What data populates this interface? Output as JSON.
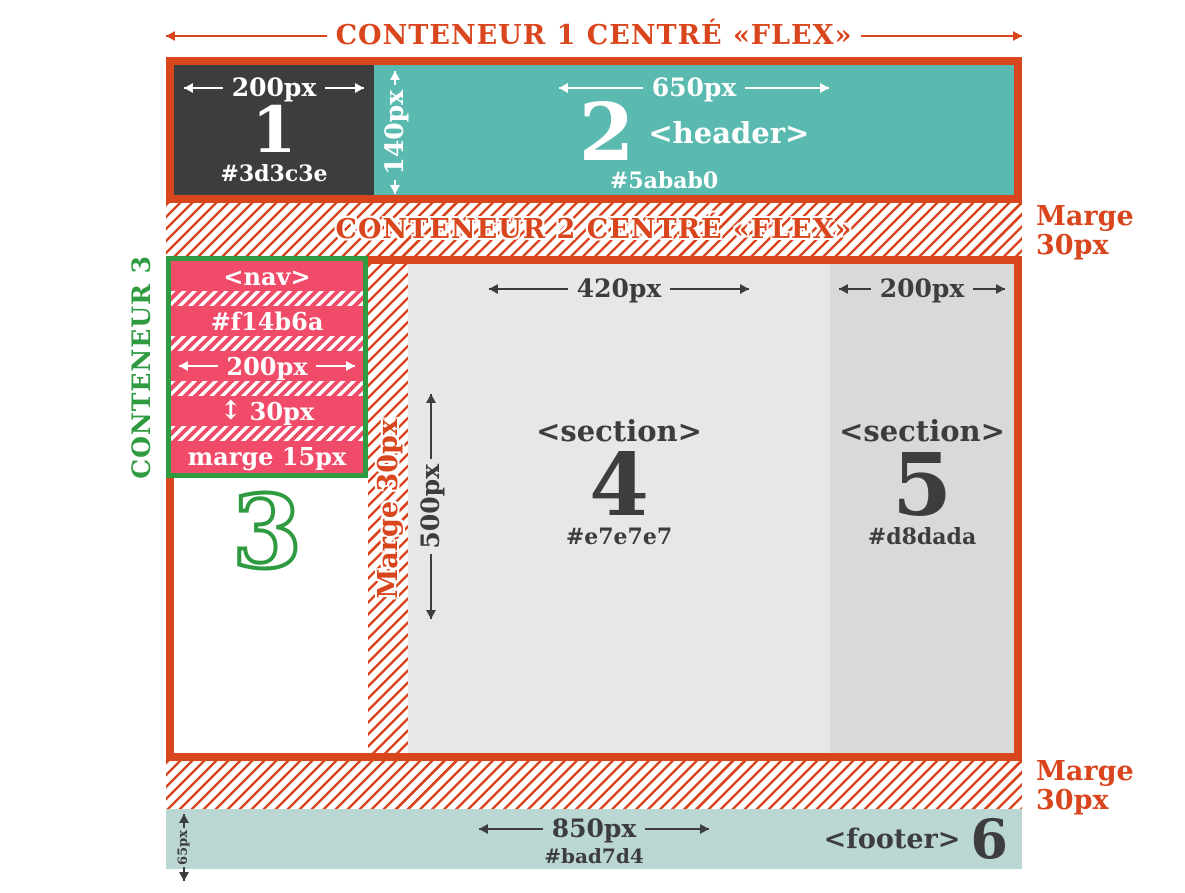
{
  "colors": {
    "accent_orange": "#d9451c",
    "teal_header": "#5abab0",
    "dark": "#3d3c3e",
    "pink_nav": "#f14b6a",
    "green": "#2f9b41",
    "gray_section4": "#e7e7e7",
    "gray_section5": "#d8dada",
    "footer_teal": "#bad7d4"
  },
  "icons": {
    "arrow_up_down": "↕"
  },
  "titles": {
    "conteneur1": "CONTENEUR 1 CENTRÉ «FLEX»",
    "conteneur2": "CONTENEUR 2 CENTRÉ «FLEX»",
    "conteneur3": "CONTENEUR 3"
  },
  "labels": {
    "marge_right_top": "Marge\n30px",
    "marge_right_bottom": "Marge\n30px",
    "marge_strip": "Marge 30px"
  },
  "block1": {
    "number": "1",
    "width_label": "200px",
    "hex": "#3d3c3e"
  },
  "block2": {
    "number": "2",
    "tag": "<header>",
    "width_label": "650px",
    "height_label": "140px",
    "hex": "#5abab0"
  },
  "nav": {
    "tag": "<nav>",
    "hex": "#f14b6a",
    "width_label": "200px",
    "row_height_label": "30px",
    "margin_label": "marge 15px"
  },
  "block3": {
    "number": "3"
  },
  "section4": {
    "number": "4",
    "tag": "<section>",
    "width_label": "420px",
    "height_label": "500px",
    "hex": "#e7e7e7"
  },
  "section5": {
    "number": "5",
    "tag": "<section>",
    "width_label": "200px",
    "hex": "#d8dada"
  },
  "footer": {
    "number": "6",
    "tag": "<footer>",
    "width_label": "850px",
    "height_label": "65px",
    "hex": "#bad7d4"
  }
}
